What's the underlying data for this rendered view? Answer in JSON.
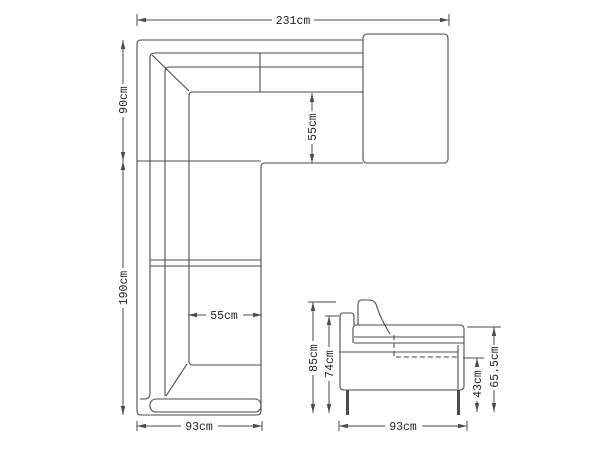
{
  "colors": {
    "line": "#4b4b4b",
    "text": "#1f1f1f",
    "background": "#ffffff"
  },
  "top_view": {
    "width_label": "231cm",
    "corner_depth_label": "90cm",
    "left_length_label": "190cm",
    "chaise_seat_depth_label": "55cm",
    "seat_width_label": "55cm",
    "bottom_depth_label": "93cm"
  },
  "side_view": {
    "overall_height_label": "85cm",
    "arm_height_label": "74cm",
    "seat_height_label": "43cm",
    "backrest_height_label": "65.5cm",
    "depth_label": "93cm"
  }
}
